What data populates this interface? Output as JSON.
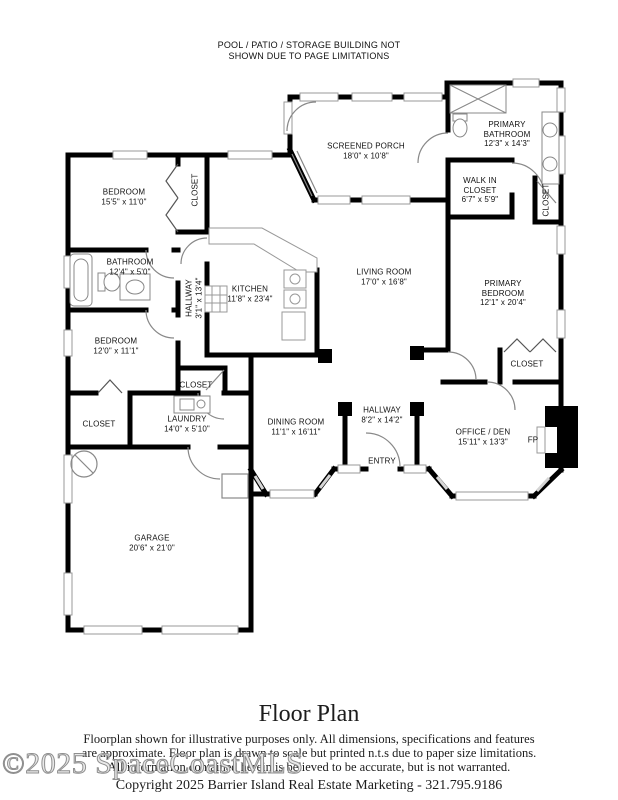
{
  "notice": {
    "line1": "POOL / PATIO / STORAGE BUILDING NOT",
    "line2": "SHOWN DUE TO PAGE LIMITATIONS"
  },
  "rooms": {
    "bedroom1": {
      "name": "BEDROOM",
      "dims": "15'5\" x 11'0\""
    },
    "closet1": {
      "name": "CLOSET"
    },
    "screened_porch": {
      "name": "SCREENED PORCH",
      "dims": "18'0\" x 10'8\""
    },
    "primary_bathroom": {
      "name": "PRIMARY BATHROOM",
      "dims": "12'3\" x 14'3\""
    },
    "walk_in_closet": {
      "name": "WALK IN CLOSET",
      "dims": "6'7\" x 5'9\""
    },
    "closet_right": {
      "name": "CLOSET"
    },
    "bathroom": {
      "name": "BATHROOM",
      "dims": "12'4\" x 5'0\""
    },
    "hallway_west": {
      "name": "HALLWAY",
      "dims": "3'1\" x 13'4\""
    },
    "kitchen": {
      "name": "KITCHEN",
      "dims": "11'8\" x 23'4\""
    },
    "living_room": {
      "name": "LIVING ROOM",
      "dims": "17'0\" x 16'8\""
    },
    "primary_bedroom": {
      "name": "PRIMARY BEDROOM",
      "dims": "12'1\" x 20'4\""
    },
    "bedroom2": {
      "name": "BEDROOM",
      "dims": "12'0\" x 11'1\""
    },
    "closet_hall": {
      "name": "CLOSET"
    },
    "closet_primary": {
      "name": "CLOSET"
    },
    "closet_bed2": {
      "name": "CLOSET"
    },
    "laundry": {
      "name": "LAUNDRY",
      "dims": "14'0\" x 5'10\""
    },
    "dining_room": {
      "name": "DINING ROOM",
      "dims": "11'1\" x 16'11\""
    },
    "hallway_main": {
      "name": "HALLWAY",
      "dims": "8'2\" x 14'2\""
    },
    "entry": {
      "name": "ENTRY"
    },
    "office_den": {
      "name": "OFFICE / DEN",
      "dims": "15'11\" x 13'3\""
    },
    "fireplace": {
      "name": "FP"
    },
    "garage": {
      "name": "GARAGE",
      "dims": "20'6\" x 21'0\""
    }
  },
  "footer": {
    "title": "Floor Plan",
    "disclaimer_line1": "Floorplan shown for illustrative purposes only. All dimensions, specifications and features",
    "disclaimer_line2": "are approximate. Floor plan is drawn to scale but printed n.t.s due to paper size limitations.",
    "disclaimer_line3": "All information contained herein is believed to be accurate, but is not warranted.",
    "watermark": "©2025 SpaceCoastMLS",
    "copyright": "Copyright 2025 Barrier Island Real Estate Marketing - 321.795.9186"
  },
  "colors": {
    "wall": "#000000",
    "window": "#999999",
    "door": "#888888",
    "text": "#111111"
  }
}
